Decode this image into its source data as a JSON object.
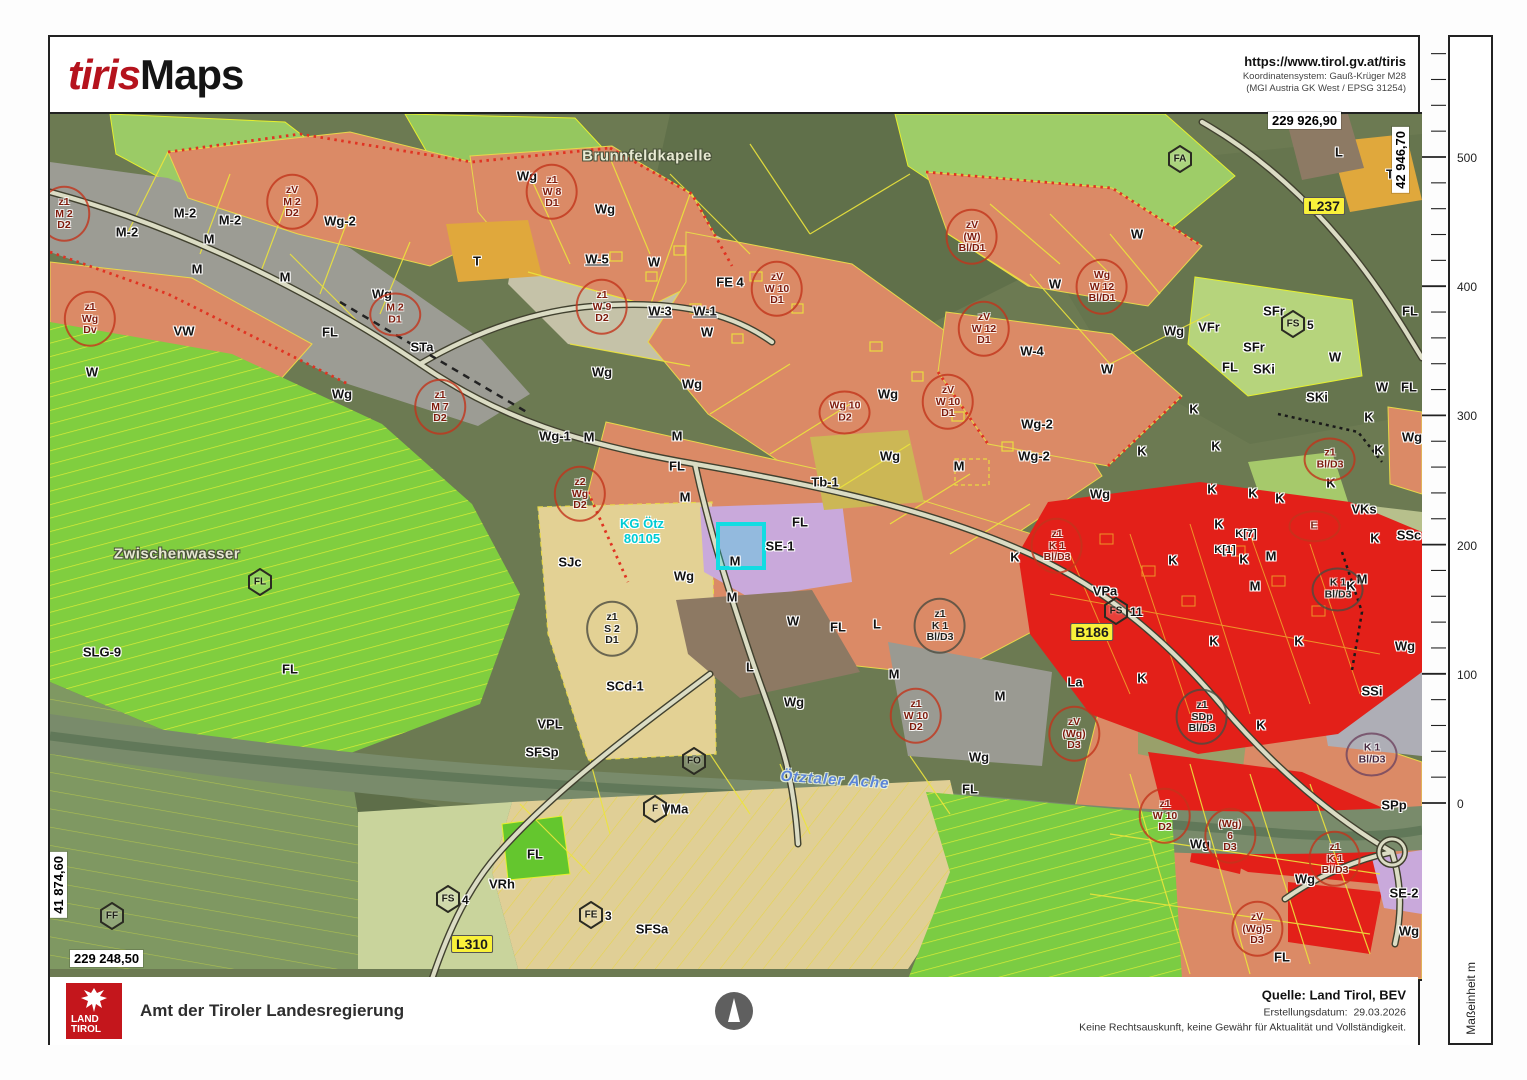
{
  "header": {
    "logo_part1": "tiris",
    "logo_part2": "Maps",
    "url": "https://www.tirol.gv.at/tiris",
    "coord_system_line1": "Koordinatensystem: Gauß-Krüger M28",
    "coord_system_line2": "(MGI Austria GK West / EPSG 31254)"
  },
  "footer": {
    "logo_line1": "LAND",
    "logo_line2": "TIROL",
    "agency": "Amt der Tiroler Landesregierung",
    "source": "Quelle: Land Tirol, BEV",
    "date_label": "Erstellungsdatum:",
    "date_value": "29.03.2026",
    "disclaimer": "Keine Rechtsauskunft, keine Gewähr für Aktualität und Vollständigkeit."
  },
  "scalebar": {
    "unit_label": "Maßeinheit m",
    "tick_values": [
      500,
      400,
      300,
      200,
      100,
      0
    ],
    "y_zero": 803,
    "px_per_m": 1.292
  },
  "map": {
    "corner_coords": {
      "top_right_x": "229 926,90",
      "top_right_y": "42 946,70",
      "bottom_left_y": "41 874,60",
      "bottom_left_x": "229 248,50"
    },
    "palette": {
      "residential_salmon": "#db8a66",
      "core_red": "#e32019",
      "mixed_gray": "#9c9c94",
      "freiland_green": "#80ce3f",
      "forest_olive": "#6c7a52",
      "special_tan": "#e3d194",
      "special_purple": "#c9a9db",
      "tourism_orange": "#e0a83c",
      "selection_cyan": "#17e0e6",
      "parcel_yellow": "#ece43c",
      "brand_red": "#b5131d",
      "logo_red": "#c4161c"
    },
    "place_labels": [
      {
        "t": "Brunnfeldkapelle",
        "x": 597,
        "y": 42
      },
      {
        "t": "Zwischenwasser",
        "x": 127,
        "y": 440
      }
    ],
    "river_label": {
      "t": "Ötztaler Ache",
      "x": 785,
      "y": 666
    },
    "kg_label": {
      "line1": "KG Ötz",
      "line2": "80105",
      "x": 592,
      "y": 418
    },
    "road_badges": [
      {
        "t": "L237",
        "x": 1274,
        "y": 92
      },
      {
        "t": "B186",
        "x": 1042,
        "y": 518
      },
      {
        "t": "L310",
        "x": 422,
        "y": 830
      }
    ],
    "hex_badges": [
      {
        "t": "FA",
        "x": 1130,
        "y": 45
      },
      {
        "t": "FS",
        "suf": "5",
        "x": 1243,
        "y": 210
      },
      {
        "t": "FS",
        "suf": "11",
        "x": 1066,
        "y": 497
      },
      {
        "t": "FL",
        "x": 210,
        "y": 468
      },
      {
        "t": "FF",
        "x": 62,
        "y": 802
      },
      {
        "t": "FS",
        "suf": "4",
        "x": 398,
        "y": 785
      },
      {
        "t": "FE",
        "suf": "3",
        "x": 541,
        "y": 801
      },
      {
        "t": "FO",
        "x": 644,
        "y": 647
      },
      {
        "t": "F",
        "x": 605,
        "y": 695
      }
    ],
    "zone_labels": [
      {
        "t": "M-2",
        "x": 135,
        "y": 99
      },
      {
        "t": "M-2",
        "x": 180,
        "y": 106
      },
      {
        "t": "M-2",
        "x": 77,
        "y": 118
      },
      {
        "t": "M",
        "x": 159,
        "y": 125
      },
      {
        "t": "M",
        "x": 147,
        "y": 155
      },
      {
        "t": "M",
        "x": 235,
        "y": 163
      },
      {
        "t": "VW",
        "x": 134,
        "y": 217
      },
      {
        "t": "Wg-2",
        "x": 290,
        "y": 107
      },
      {
        "t": "T",
        "x": 427,
        "y": 147
      },
      {
        "t": "STa",
        "x": 372,
        "y": 233
      },
      {
        "t": "FL",
        "x": 280,
        "y": 218
      },
      {
        "t": "W",
        "x": 42,
        "y": 258
      },
      {
        "t": "Wg",
        "x": 292,
        "y": 280
      },
      {
        "t": "Wg",
        "x": 477,
        "y": 62
      },
      {
        "t": "Wg",
        "x": 555,
        "y": 95
      },
      {
        "t": "W-5",
        "x": 547,
        "y": 145,
        "cls": "u"
      },
      {
        "t": "W",
        "x": 604,
        "y": 148
      },
      {
        "t": "W-3",
        "x": 610,
        "y": 197,
        "cls": "u"
      },
      {
        "t": "W-1",
        "x": 655,
        "y": 197,
        "cls": "u"
      },
      {
        "t": "W",
        "x": 657,
        "y": 218
      },
      {
        "t": "FE 4",
        "x": 680,
        "y": 168
      },
      {
        "t": "Wg",
        "x": 552,
        "y": 258
      },
      {
        "t": "Wg",
        "x": 642,
        "y": 270
      },
      {
        "t": "Wg-1",
        "x": 505,
        "y": 322
      },
      {
        "t": "M",
        "x": 539,
        "y": 323
      },
      {
        "t": "M",
        "x": 627,
        "y": 322
      },
      {
        "t": "FL",
        "x": 627,
        "y": 352
      },
      {
        "t": "M",
        "x": 635,
        "y": 383
      },
      {
        "t": "M",
        "x": 682,
        "y": 483
      },
      {
        "t": "M",
        "x": 685,
        "y": 447
      },
      {
        "t": "SE-1",
        "x": 730,
        "y": 432
      },
      {
        "t": "Tb-1",
        "x": 775,
        "y": 368
      },
      {
        "t": "Wg",
        "x": 840,
        "y": 342
      },
      {
        "t": "M",
        "x": 909,
        "y": 352
      },
      {
        "t": "Wg",
        "x": 838,
        "y": 280
      },
      {
        "t": "Wg-2",
        "x": 987,
        "y": 310
      },
      {
        "t": "Wg-2",
        "x": 984,
        "y": 342
      },
      {
        "t": "Wg",
        "x": 1050,
        "y": 380
      },
      {
        "t": "K",
        "x": 965,
        "y": 443
      },
      {
        "t": "W",
        "x": 1087,
        "y": 120
      },
      {
        "t": "W",
        "x": 1005,
        "y": 170
      },
      {
        "t": "W-4",
        "x": 982,
        "y": 237
      },
      {
        "t": "W",
        "x": 1057,
        "y": 255
      },
      {
        "t": "Wg",
        "x": 1124,
        "y": 217
      },
      {
        "t": "VFr",
        "x": 1159,
        "y": 213
      },
      {
        "t": "SFr",
        "x": 1224,
        "y": 197
      },
      {
        "t": "SFr",
        "x": 1204,
        "y": 233
      },
      {
        "t": "FL",
        "x": 1180,
        "y": 253
      },
      {
        "t": "SKi",
        "x": 1214,
        "y": 255
      },
      {
        "t": "SKi",
        "x": 1267,
        "y": 283
      },
      {
        "t": "W",
        "x": 1285,
        "y": 243
      },
      {
        "t": "W",
        "x": 1332,
        "y": 273
      },
      {
        "t": "FL",
        "x": 1359,
        "y": 273
      },
      {
        "t": "FL",
        "x": 1360,
        "y": 197
      },
      {
        "t": "L",
        "x": 1289,
        "y": 38
      },
      {
        "t": "T",
        "x": 1340,
        "y": 60
      },
      {
        "t": "Wg",
        "x": 1362,
        "y": 323
      },
      {
        "t": "K",
        "x": 1144,
        "y": 295
      },
      {
        "t": "K",
        "x": 1166,
        "y": 332
      },
      {
        "t": "K",
        "x": 1092,
        "y": 337
      },
      {
        "t": "K",
        "x": 1162,
        "y": 375
      },
      {
        "t": "K",
        "x": 1203,
        "y": 379
      },
      {
        "t": "K",
        "x": 1230,
        "y": 384
      },
      {
        "t": "K",
        "x": 1281,
        "y": 369
      },
      {
        "t": "K",
        "x": 1319,
        "y": 303
      },
      {
        "t": "K",
        "x": 1329,
        "y": 336
      },
      {
        "t": "K[7]",
        "x": 1196,
        "y": 420,
        "cls": "sm"
      },
      {
        "t": "K[1]",
        "x": 1175,
        "y": 436,
        "cls": "sm"
      },
      {
        "t": "M",
        "x": 1221,
        "y": 442
      },
      {
        "t": "M",
        "x": 1205,
        "y": 472
      },
      {
        "t": "M",
        "x": 1312,
        "y": 465
      },
      {
        "t": "VKs",
        "x": 1314,
        "y": 395
      },
      {
        "t": "SSc",
        "x": 1359,
        "y": 421
      },
      {
        "t": "K",
        "x": 1169,
        "y": 410
      },
      {
        "t": "K",
        "x": 1123,
        "y": 446
      },
      {
        "t": "K",
        "x": 1194,
        "y": 445
      },
      {
        "t": "K",
        "x": 1301,
        "y": 472
      },
      {
        "t": "K",
        "x": 1325,
        "y": 424
      },
      {
        "t": "K",
        "x": 1164,
        "y": 527
      },
      {
        "t": "K",
        "x": 1249,
        "y": 527
      },
      {
        "t": "M",
        "x": 950,
        "y": 582
      },
      {
        "t": "La",
        "x": 1025,
        "y": 568
      },
      {
        "t": "K",
        "x": 1092,
        "y": 564
      },
      {
        "t": "VPa",
        "x": 1055,
        "y": 477
      },
      {
        "t": "SJc",
        "x": 520,
        "y": 448
      },
      {
        "t": "Wg",
        "x": 634,
        "y": 462
      },
      {
        "t": "SCd-1",
        "x": 575,
        "y": 572
      },
      {
        "t": "VPL",
        "x": 500,
        "y": 610
      },
      {
        "t": "SFSp",
        "x": 492,
        "y": 638
      },
      {
        "t": "L",
        "x": 700,
        "y": 553
      },
      {
        "t": "Wg",
        "x": 744,
        "y": 588
      },
      {
        "t": "M",
        "x": 844,
        "y": 560
      },
      {
        "t": "Wg",
        "x": 929,
        "y": 643
      },
      {
        "t": "FL",
        "x": 920,
        "y": 675
      },
      {
        "t": "L",
        "x": 827,
        "y": 510
      },
      {
        "t": "FL",
        "x": 788,
        "y": 513
      },
      {
        "t": "W",
        "x": 743,
        "y": 507
      },
      {
        "t": "FL",
        "x": 750,
        "y": 408
      },
      {
        "t": "SLG-9",
        "x": 52,
        "y": 538
      },
      {
        "t": "FL",
        "x": 240,
        "y": 555
      },
      {
        "t": "SSi",
        "x": 1322,
        "y": 577
      },
      {
        "t": "K",
        "x": 1211,
        "y": 611
      },
      {
        "t": "SPp",
        "x": 1344,
        "y": 691
      },
      {
        "t": "SE-2",
        "x": 1354,
        "y": 779
      },
      {
        "t": "Wg",
        "x": 1359,
        "y": 817
      },
      {
        "t": "FL",
        "x": 1232,
        "y": 843
      },
      {
        "t": "Wg",
        "x": 1255,
        "y": 765
      },
      {
        "t": "Wg",
        "x": 1150,
        "y": 730
      },
      {
        "t": "VRh",
        "x": 452,
        "y": 770
      },
      {
        "t": "FL",
        "x": 485,
        "y": 740
      },
      {
        "t": "SFSa",
        "x": 602,
        "y": 815
      },
      {
        "t": "VMa",
        "x": 625,
        "y": 695
      },
      {
        "t": "Wg",
        "x": 332,
        "y": 180
      },
      {
        "t": "Wg",
        "x": 1355,
        "y": 532
      }
    ],
    "annotations": [
      {
        "x": 14,
        "y": 100,
        "c": "red",
        "lines": [
          "z1",
          "M 2",
          "D2"
        ]
      },
      {
        "x": 40,
        "y": 205,
        "c": "red",
        "lines": [
          "z1",
          "Wg",
          "Dv"
        ]
      },
      {
        "x": 242,
        "y": 88,
        "c": "red",
        "lines": [
          "zV",
          "M 2",
          "D2"
        ]
      },
      {
        "x": 345,
        "y": 200,
        "c": "red",
        "lines": [
          "M 2",
          "D1"
        ]
      },
      {
        "x": 390,
        "y": 293,
        "c": "red",
        "lines": [
          "z1",
          "M 7",
          "D2"
        ]
      },
      {
        "x": 502,
        "y": 78,
        "c": "red",
        "lines": [
          "z1",
          "W 8",
          "D1"
        ]
      },
      {
        "x": 552,
        "y": 193,
        "c": "red",
        "lines": [
          "z1",
          "W 9",
          "D2"
        ]
      },
      {
        "x": 727,
        "y": 175,
        "c": "red",
        "lines": [
          "zV",
          "W 10",
          "D1"
        ]
      },
      {
        "x": 922,
        "y": 123,
        "c": "red",
        "lines": [
          "zV",
          "(W)",
          "Bl/D1"
        ]
      },
      {
        "x": 1052,
        "y": 173,
        "c": "red",
        "lines": [
          "Wg",
          "W 12",
          "Bl/D1"
        ]
      },
      {
        "x": 934,
        "y": 215,
        "c": "red",
        "lines": [
          "zV",
          "W 12",
          "D1"
        ]
      },
      {
        "x": 898,
        "y": 288,
        "c": "red",
        "lines": [
          "zV",
          "W 10",
          "D1"
        ]
      },
      {
        "x": 795,
        "y": 298,
        "c": "red",
        "lines": [
          "Wg 10",
          "D2"
        ]
      },
      {
        "x": 530,
        "y": 380,
        "c": "red",
        "lines": [
          "z2",
          "Wg",
          "D2"
        ]
      },
      {
        "x": 562,
        "y": 515,
        "c": "dark",
        "lines": [
          "z1",
          "S 2",
          "D1"
        ]
      },
      {
        "x": 890,
        "y": 512,
        "c": "dark",
        "lines": [
          "z1",
          "K 1",
          "Bl/D3"
        ]
      },
      {
        "x": 1007,
        "y": 432,
        "c": "red",
        "lines": [
          "z1",
          "K 1",
          "Bl/D3"
        ]
      },
      {
        "x": 1280,
        "y": 345,
        "c": "red",
        "lines": [
          "z1",
          "Bl/D3"
        ]
      },
      {
        "x": 1288,
        "y": 475,
        "c": "dark",
        "lines": [
          "K 1",
          "Bl/D3"
        ]
      },
      {
        "x": 1264,
        "y": 412,
        "c": "red",
        "lines": [
          "E"
        ]
      },
      {
        "x": 1152,
        "y": 603,
        "c": "dark",
        "lines": [
          "z1",
          "SDp",
          "Bl/D3"
        ]
      },
      {
        "x": 866,
        "y": 602,
        "c": "red",
        "lines": [
          "z1",
          "W 10",
          "D2"
        ]
      },
      {
        "x": 1024,
        "y": 620,
        "c": "red",
        "lines": [
          "zV",
          "(Wg)",
          "D3"
        ]
      },
      {
        "x": 1115,
        "y": 702,
        "c": "red",
        "lines": [
          "z1",
          "W 10",
          "D2"
        ]
      },
      {
        "x": 1180,
        "y": 722,
        "c": "red",
        "lines": [
          "(Wg)",
          "6",
          "D3"
        ]
      },
      {
        "x": 1207,
        "y": 815,
        "c": "red",
        "lines": [
          "zV",
          "(Wg)5",
          "D3"
        ]
      },
      {
        "x": 1322,
        "y": 640,
        "c": "purple",
        "lines": [
          "K 1",
          "Bl/D3"
        ]
      },
      {
        "x": 1285,
        "y": 745,
        "c": "red",
        "lines": [
          "z1",
          "K 1",
          "Bl/D3"
        ]
      }
    ]
  }
}
